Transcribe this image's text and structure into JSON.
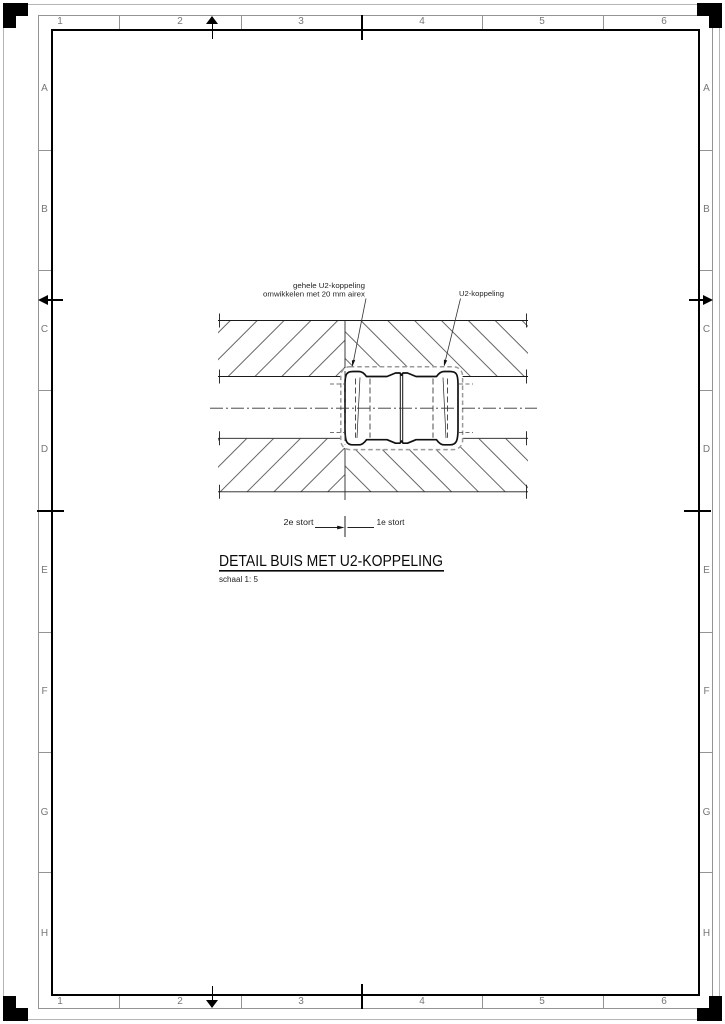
{
  "sheet": {
    "top_numbers": [
      "1",
      "2",
      "3",
      "4",
      "5",
      "6"
    ],
    "bottom_numbers": [
      "1",
      "2",
      "3",
      "4",
      "5",
      "6"
    ],
    "left_letters": [
      "A",
      "B",
      "C",
      "D",
      "E",
      "F",
      "G",
      "H"
    ],
    "right_letters": [
      "A",
      "B",
      "C",
      "D",
      "E",
      "F",
      "G",
      "H"
    ]
  },
  "drawing": {
    "callout_airex_line1": "gehele U2-koppeling",
    "callout_airex_line2": "omwikkelen met 20 mm airex",
    "callout_coupling": "U2-koppeling",
    "pour_label_left": "2e stort",
    "pour_label_right": "1e stort",
    "title": "DETAIL BUIS MET U2-KOPPELING",
    "scale_note": "schaal 1: 5"
  },
  "colors": {
    "line": "#1a1a1a",
    "hatch": "#4a4a4a",
    "band_line": "#949494",
    "band_label": "#777777",
    "wrap_dash": "#9a9a9a"
  }
}
